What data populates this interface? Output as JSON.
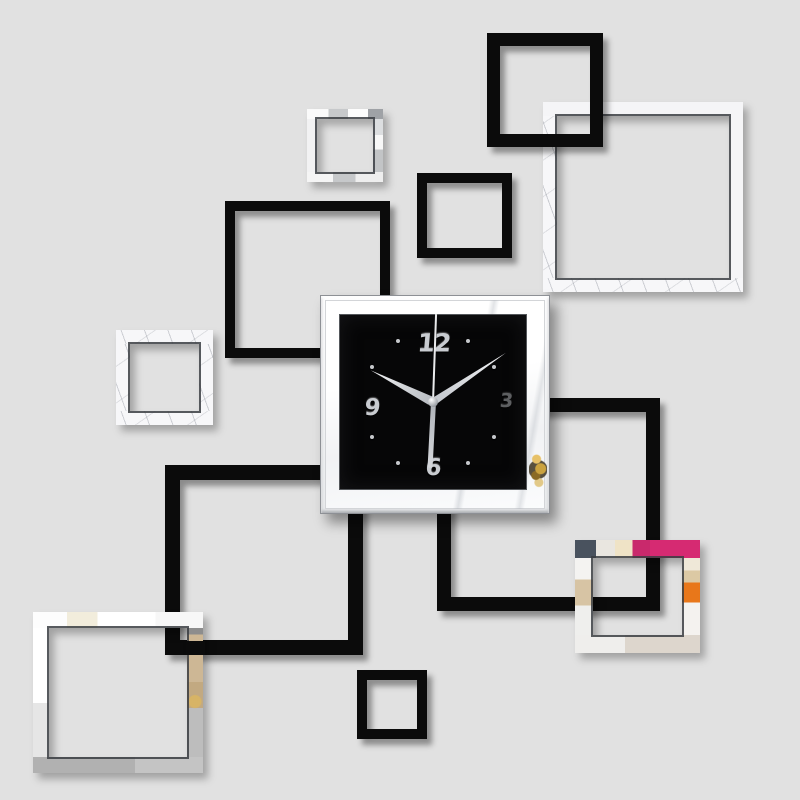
{
  "scene": {
    "description": "Product photo: DIY 3D acrylic mirror wall clock sticker set of overlapping black and mirrored square frames on a plain light-gray wall",
    "wall_color": "#e1e1e1"
  },
  "palette": {
    "wall": "#e1e1e1",
    "black": "#0b0b0b",
    "face": "#060607",
    "silver": "#f5f6f7",
    "magenta": "#c9296c",
    "orange": "#e8771a",
    "beige": "#d2bd9c",
    "gold": "#c69a3d"
  },
  "squares": [
    {
      "name": "mirror-square-top-right",
      "style": "mirror",
      "x": 543,
      "y": 102,
      "w": 200,
      "h": 190,
      "bw": 14,
      "z": 1
    },
    {
      "name": "black-square-top",
      "style": "black",
      "x": 487,
      "y": 33,
      "w": 116,
      "h": 114,
      "bw": 13,
      "z": 2
    },
    {
      "name": "mirror-square-top-small",
      "style": "mirror",
      "x": 307,
      "y": 109,
      "w": 76,
      "h": 73,
      "bw": 10,
      "z": 2
    },
    {
      "name": "black-square-mid",
      "style": "black",
      "x": 417,
      "y": 173,
      "w": 95,
      "h": 85,
      "bw": 10,
      "z": 2
    },
    {
      "name": "black-square-left",
      "style": "black",
      "x": 225,
      "y": 201,
      "w": 165,
      "h": 157,
      "bw": 10,
      "z": 2
    },
    {
      "name": "mirror-square-left",
      "style": "mirror",
      "x": 116,
      "y": 330,
      "w": 97,
      "h": 95,
      "bw": 14,
      "z": 3
    },
    {
      "name": "black-frame-right",
      "style": "black",
      "x": 437,
      "y": 398,
      "w": 223,
      "h": 213,
      "bw": 14,
      "z": 3
    },
    {
      "name": "black-frame-bottom",
      "style": "black",
      "x": 165,
      "y": 465,
      "w": 198,
      "h": 190,
      "bw": 15,
      "z": 4
    },
    {
      "name": "black-square-small-bottom",
      "style": "black",
      "x": 357,
      "y": 670,
      "w": 70,
      "h": 69,
      "bw": 10,
      "z": 4
    },
    {
      "name": "mirror-square-colorful",
      "style": "mirror",
      "x": 575,
      "y": 540,
      "w": 125,
      "h": 113,
      "bw": 18,
      "z": 5
    },
    {
      "name": "mirror-square-bottom-left",
      "style": "mirror",
      "x": 33,
      "y": 612,
      "w": 170,
      "h": 161,
      "bw": 16,
      "z": 5
    },
    {
      "name": "black-bar-patch",
      "style": "solid",
      "x": 186,
      "y": 641,
      "w": 19,
      "h": 14,
      "bw": 0,
      "z": 6
    }
  ],
  "clock": {
    "time_display": "10:09",
    "numerals": {
      "twelve": "12",
      "three": "3",
      "six": "6",
      "nine": "9"
    },
    "hands": {
      "hour_deg": 297,
      "minute_deg": 56,
      "second_deg": 2,
      "tail_deg": 183
    },
    "dot_angles": [
      30,
      60,
      120,
      150,
      210,
      240,
      300,
      330
    ],
    "dot_radius": 70
  }
}
